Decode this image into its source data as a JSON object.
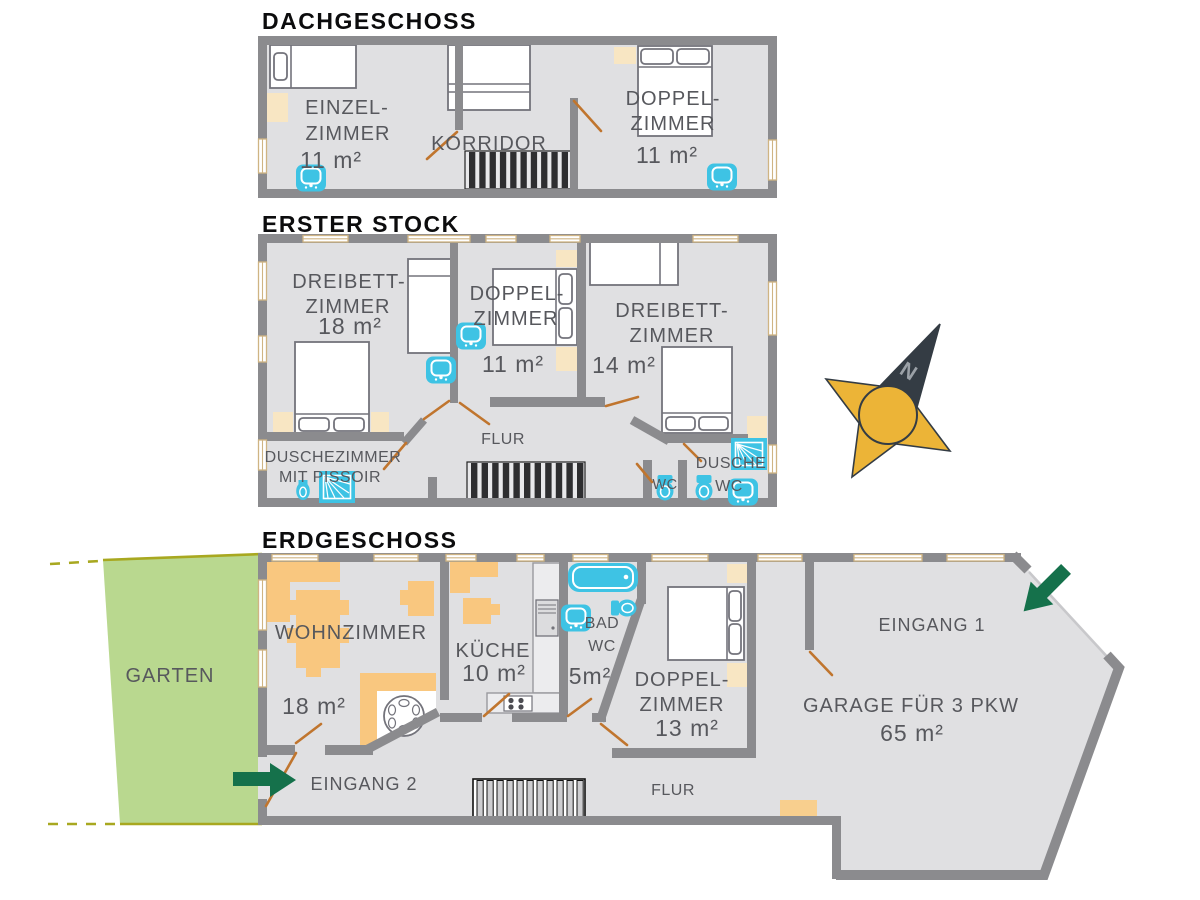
{
  "floors": {
    "dach": {
      "title": "DACHGESCHOSS",
      "rooms": {
        "einzel": {
          "l1": "EINZEL-",
          "l2": "ZIMMER",
          "area": "11 m²"
        },
        "korridor": {
          "label": "KORRIDOR"
        },
        "doppel": {
          "l1": "DOPPEL-",
          "l2": "ZIMMER",
          "area": "11 m²"
        }
      }
    },
    "erster": {
      "title": "ERSTER STOCK",
      "rooms": {
        "dreibett_links": {
          "l1": "DREIBETT-",
          "l2": "ZIMMER",
          "area": "18 m²"
        },
        "doppel": {
          "l1": "DOPPEL-",
          "l2": "ZIMMER",
          "area": "11 m²"
        },
        "dreibett_rechts": {
          "l1": "DREIBETT-",
          "l2": "ZIMMER",
          "area": "14 m²"
        },
        "dusche": {
          "l1": "DUSCHEZIMMER",
          "l2": "MIT PISSOIR"
        },
        "flur": {
          "label": "FLUR"
        },
        "wc": {
          "label": "WC"
        },
        "dusche_wc": {
          "l1": "DUSCHE",
          "l2": "WC"
        }
      }
    },
    "erd": {
      "title": "ERDGESCHOSS",
      "rooms": {
        "garten": {
          "label": "GARTEN"
        },
        "wohnzimmer": {
          "label": "WOHNZIMMER",
          "area": "18 m²"
        },
        "kueche": {
          "label": "KÜCHE",
          "area": "10 m²"
        },
        "bad": {
          "l1": "BAD",
          "l2": "WC",
          "area": "5m²"
        },
        "doppel": {
          "l1": "DOPPEL-",
          "l2": "ZIMMER",
          "area": "13 m²"
        },
        "flur": {
          "label": "FLUR"
        },
        "eingang1": {
          "label": "EINGANG 1"
        },
        "eingang2": {
          "label": "EINGANG 2"
        },
        "garage": {
          "label": "GARAGE FÜR 3 PKW",
          "area": "65 m²"
        }
      }
    }
  },
  "compass": {
    "north_label": "N"
  },
  "colors": {
    "wall": "#8b8b8e",
    "floor": "#e0e0e2",
    "furniture_orange": "#f9c77f",
    "furniture_beige": "#f8e6c3",
    "fixture_cyan": "#3ec3e4",
    "door_leaf": "#c0752e",
    "garden_green": "#b9d88f",
    "garden_border": "#a8a820",
    "arrow_green": "#15714b",
    "compass_gold": "#ecb437",
    "compass_dark": "#343c44",
    "label_gray": "#57585d"
  }
}
